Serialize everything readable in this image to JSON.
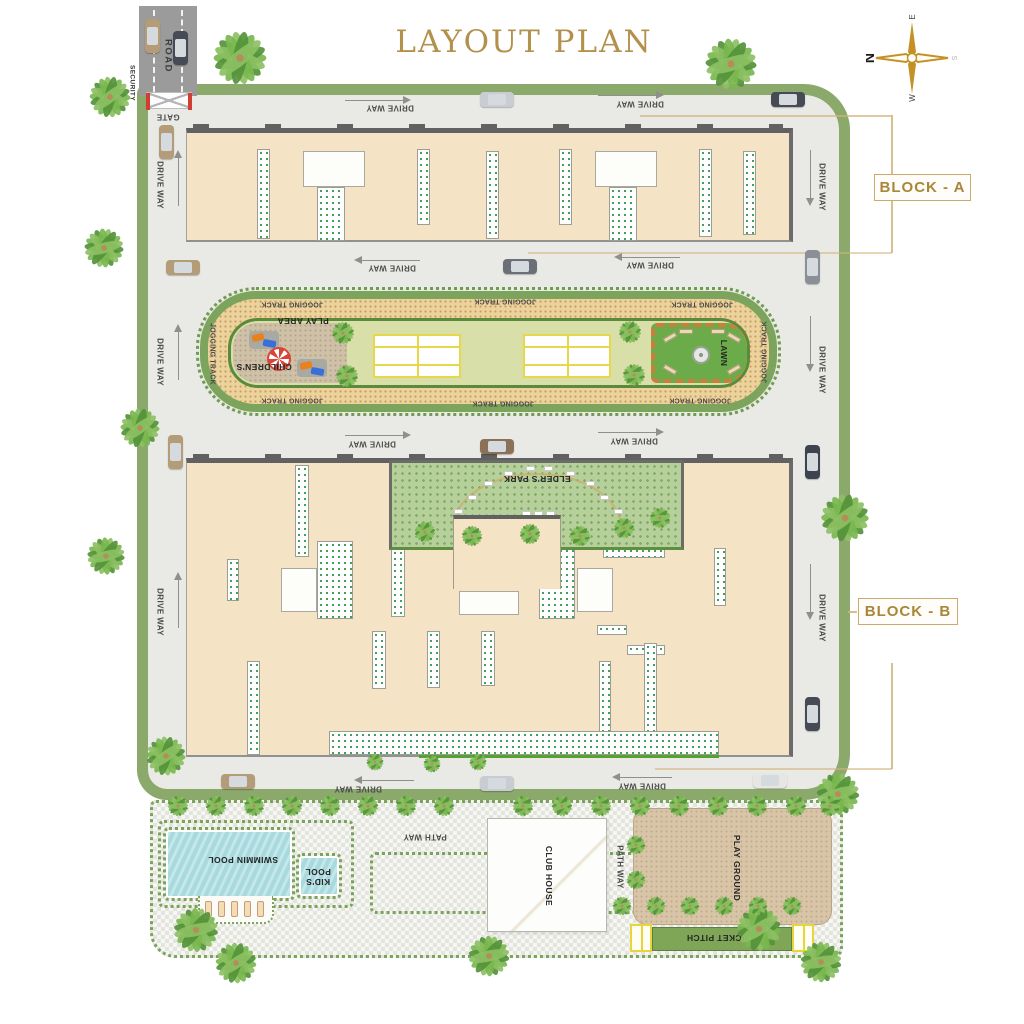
{
  "title": "LAYOUT PLAN",
  "compass": {
    "north": "N",
    "east": "E",
    "west": "W",
    "south": "S"
  },
  "block_labels": [
    {
      "id": "block-a",
      "text": "BLOCK - A"
    },
    {
      "id": "block-b",
      "text": "BLOCK - B"
    }
  ],
  "colors": {
    "gold_accent": "#a8863a",
    "boundary_green": "#8aa96a",
    "driveway_gray": "#e9e9e6",
    "building_beige": "#f4e3c4",
    "track_tan": "#ecd39e",
    "lawn_light": "#d8dfa8",
    "lawn_dark": "#6cab4a",
    "park_green": "#b7cf9a",
    "pool_water": "#a9dde1",
    "playground_tan": "#d8c5a8",
    "cricket_green": "#7fa557",
    "court_line_yellow": "#e7d74b",
    "road_gray": "#9b9b9b"
  },
  "map_labels": [
    {
      "name": "road-label",
      "text": "ROAD",
      "x": 168,
      "y": 56,
      "rot": 90,
      "cls": "lbl-road"
    },
    {
      "name": "security-label",
      "text": "SECURITY",
      "x": 132,
      "y": 83,
      "rot": 90,
      "cls": "lbl-tiny"
    },
    {
      "name": "gate-label",
      "text": "GATE",
      "x": 168,
      "y": 117,
      "rot": 180,
      "cls": ""
    },
    {
      "name": "driveway-label",
      "text": "DRIVE WAY",
      "x": 390,
      "y": 108,
      "rot": 180,
      "cls": ""
    },
    {
      "name": "driveway-label",
      "text": "DRIVE WAY",
      "x": 640,
      "y": 104,
      "rot": 180,
      "cls": ""
    },
    {
      "name": "driveway-label",
      "text": "DRIVE WAY",
      "x": 160,
      "y": 185,
      "rot": 90,
      "cls": ""
    },
    {
      "name": "driveway-label",
      "text": "DRIVE WAY",
      "x": 822,
      "y": 187,
      "rot": 90,
      "cls": ""
    },
    {
      "name": "driveway-label",
      "text": "DRIVE WAY",
      "x": 392,
      "y": 268,
      "rot": 180,
      "cls": ""
    },
    {
      "name": "driveway-label",
      "text": "DRIVE WAY",
      "x": 650,
      "y": 265,
      "rot": 180,
      "cls": ""
    },
    {
      "name": "driveway-label",
      "text": "DRIVE WAY",
      "x": 160,
      "y": 362,
      "rot": 90,
      "cls": ""
    },
    {
      "name": "driveway-label",
      "text": "DRIVE WAY",
      "x": 822,
      "y": 370,
      "rot": 90,
      "cls": ""
    },
    {
      "name": "driveway-label",
      "text": "DRIVE WAY",
      "x": 372,
      "y": 444,
      "rot": 180,
      "cls": ""
    },
    {
      "name": "driveway-label",
      "text": "DRIVE WAY",
      "x": 634,
      "y": 441,
      "rot": 180,
      "cls": ""
    },
    {
      "name": "driveway-label",
      "text": "DRIVE WAY",
      "x": 160,
      "y": 612,
      "rot": 90,
      "cls": ""
    },
    {
      "name": "driveway-label",
      "text": "DRIVE WAY",
      "x": 822,
      "y": 618,
      "rot": 90,
      "cls": ""
    },
    {
      "name": "driveway-label",
      "text": "DRIVE WAY",
      "x": 358,
      "y": 789,
      "rot": 180,
      "cls": ""
    },
    {
      "name": "driveway-label",
      "text": "DRIVE WAY",
      "x": 642,
      "y": 786,
      "rot": 180,
      "cls": ""
    },
    {
      "name": "jogging-track-label",
      "text": "JOGGING TRACK",
      "x": 292,
      "y": 304,
      "rot": 180,
      "cls": "lbl-track"
    },
    {
      "name": "jogging-track-label",
      "text": "JOGGING TRACK",
      "x": 505,
      "y": 301,
      "rot": 180,
      "cls": "lbl-track"
    },
    {
      "name": "jogging-track-label",
      "text": "JOGGING TRACK",
      "x": 702,
      "y": 304,
      "rot": 180,
      "cls": "lbl-track"
    },
    {
      "name": "jogging-track-label",
      "text": "JOGGING TRACK",
      "x": 292,
      "y": 400,
      "rot": 180,
      "cls": "lbl-track"
    },
    {
      "name": "jogging-track-label",
      "text": "JOGGING TRACK",
      "x": 503,
      "y": 403,
      "rot": 180,
      "cls": "lbl-track"
    },
    {
      "name": "jogging-track-label",
      "text": "JOGGING TRACK",
      "x": 700,
      "y": 400,
      "rot": 180,
      "cls": "lbl-track"
    },
    {
      "name": "jogging-track-label",
      "text": "JOGGING TRACK",
      "x": 212,
      "y": 354,
      "rot": 90,
      "cls": "lbl-track"
    },
    {
      "name": "jogging-track-label",
      "text": "JOGGING TRACK",
      "x": 765,
      "y": 352,
      "rot": -90,
      "cls": "lbl-track"
    },
    {
      "name": "play-area-label",
      "text": "PLAY AREA",
      "x": 303,
      "y": 321,
      "rot": 180,
      "cls": "lbl-area"
    },
    {
      "name": "childrens-label",
      "text": "CHILDREN'S",
      "x": 264,
      "y": 367,
      "rot": 180,
      "cls": "lbl-area"
    },
    {
      "name": "lawn-label",
      "text": "LAWN",
      "x": 724,
      "y": 353,
      "rot": 90,
      "cls": "lbl-area"
    },
    {
      "name": "elders-park-label",
      "text": "ELDER'S PARK",
      "x": 537,
      "y": 479,
      "rot": 180,
      "cls": "lbl-area"
    },
    {
      "name": "swimming-pool-label",
      "text": "SWIMMIN POOL",
      "x": 243,
      "y": 860,
      "rot": 180,
      "cls": "lbl-area"
    },
    {
      "name": "kids-pool-label",
      "text": "KID'S POOL",
      "x": 318,
      "y": 876,
      "rot": 180,
      "cls": "lbl-area lbl-wrap"
    },
    {
      "name": "path-way-label",
      "text": "PATH WAY",
      "x": 425,
      "y": 837,
      "rot": 180,
      "cls": ""
    },
    {
      "name": "club-house-label",
      "text": "CLUB HOUSE",
      "x": 549,
      "y": 876,
      "rot": 90,
      "cls": "lbl-area"
    },
    {
      "name": "path-way-label",
      "text": "PATH WAY",
      "x": 620,
      "y": 867,
      "rot": 90,
      "cls": ""
    },
    {
      "name": "play-ground-label",
      "text": "PLAY GROUND",
      "x": 737,
      "y": 868,
      "rot": 90,
      "cls": "lbl-area"
    },
    {
      "name": "cricket-pitch-label",
      "text": "CRICKET PITCH",
      "x": 722,
      "y": 938,
      "rot": 180,
      "cls": "lbl-area"
    }
  ],
  "decor": {
    "trees": [
      [
        240,
        58,
        62
      ],
      [
        731,
        64,
        60
      ],
      [
        845,
        518,
        56
      ],
      [
        838,
        794,
        50
      ],
      [
        110,
        97,
        48
      ],
      [
        104,
        248,
        46
      ],
      [
        140,
        428,
        46
      ],
      [
        106,
        556,
        44
      ],
      [
        166,
        756,
        46
      ],
      [
        196,
        930,
        52
      ],
      [
        236,
        963,
        48
      ],
      [
        489,
        956,
        48
      ],
      [
        759,
        929,
        52
      ],
      [
        821,
        962,
        48
      ],
      [
        343,
        333,
        26
      ],
      [
        347,
        376,
        26
      ],
      [
        630,
        332,
        26
      ],
      [
        634,
        375,
        26
      ],
      [
        425,
        532,
        24
      ],
      [
        472,
        536,
        24
      ],
      [
        530,
        534,
        24
      ],
      [
        580,
        536,
        24
      ],
      [
        624,
        528,
        24
      ],
      [
        660,
        518,
        24
      ],
      [
        375,
        762,
        20
      ],
      [
        432,
        764,
        20
      ],
      [
        478,
        762,
        20
      ],
      [
        178,
        806,
        24
      ],
      [
        216,
        806,
        24
      ],
      [
        254,
        806,
        24
      ],
      [
        292,
        806,
        24
      ],
      [
        330,
        806,
        24
      ],
      [
        368,
        806,
        24
      ],
      [
        406,
        806,
        24
      ],
      [
        444,
        806,
        24
      ],
      [
        523,
        806,
        24
      ],
      [
        562,
        806,
        24
      ],
      [
        601,
        806,
        24
      ],
      [
        640,
        806,
        24
      ],
      [
        679,
        806,
        24
      ],
      [
        718,
        806,
        24
      ],
      [
        757,
        806,
        24
      ],
      [
        796,
        806,
        24
      ],
      [
        830,
        806,
        24
      ],
      [
        622,
        906,
        22
      ],
      [
        656,
        906,
        22
      ],
      [
        690,
        906,
        22
      ],
      [
        724,
        906,
        22
      ],
      [
        758,
        906,
        22
      ],
      [
        792,
        906,
        22
      ],
      [
        636,
        845,
        22
      ],
      [
        636,
        880,
        22
      ]
    ],
    "cars": [
      [
        152,
        36,
        "v",
        "#b39c77"
      ],
      [
        180,
        48,
        "v",
        "#454a54"
      ],
      [
        166,
        142,
        "v",
        "#b39c77"
      ],
      [
        497,
        99,
        "h",
        "#c9cdd3"
      ],
      [
        788,
        99,
        "h",
        "#454a54"
      ],
      [
        183,
        267,
        "h",
        "#b39c77"
      ],
      [
        520,
        266,
        "h",
        "#6b7078"
      ],
      [
        812,
        267,
        "v",
        "#8b9097"
      ],
      [
        175,
        452,
        "v",
        "#b39c77"
      ],
      [
        497,
        446,
        "h",
        "#8a7157"
      ],
      [
        812,
        462,
        "v",
        "#3d4450"
      ],
      [
        812,
        714,
        "v",
        "#454a54"
      ],
      [
        238,
        781,
        "h",
        "#b39c77"
      ],
      [
        497,
        783,
        "h",
        "#c9cdd3"
      ],
      [
        770,
        780,
        "h",
        "#e6e6e3"
      ]
    ],
    "arrows": [
      [
        345,
        96,
        "r",
        68
      ],
      [
        598,
        91,
        "r",
        68
      ],
      [
        352,
        256,
        "l",
        68
      ],
      [
        612,
        253,
        "l",
        68
      ],
      [
        345,
        431,
        "r",
        68
      ],
      [
        598,
        428,
        "r",
        68
      ],
      [
        352,
        776,
        "l",
        62
      ],
      [
        610,
        773,
        "l",
        62
      ],
      [
        174,
        148,
        "u",
        58
      ],
      [
        174,
        322,
        "u",
        58
      ],
      [
        174,
        570,
        "u",
        58
      ],
      [
        806,
        150,
        "d",
        58
      ],
      [
        806,
        316,
        "d",
        58
      ],
      [
        806,
        564,
        "d",
        58
      ]
    ]
  }
}
